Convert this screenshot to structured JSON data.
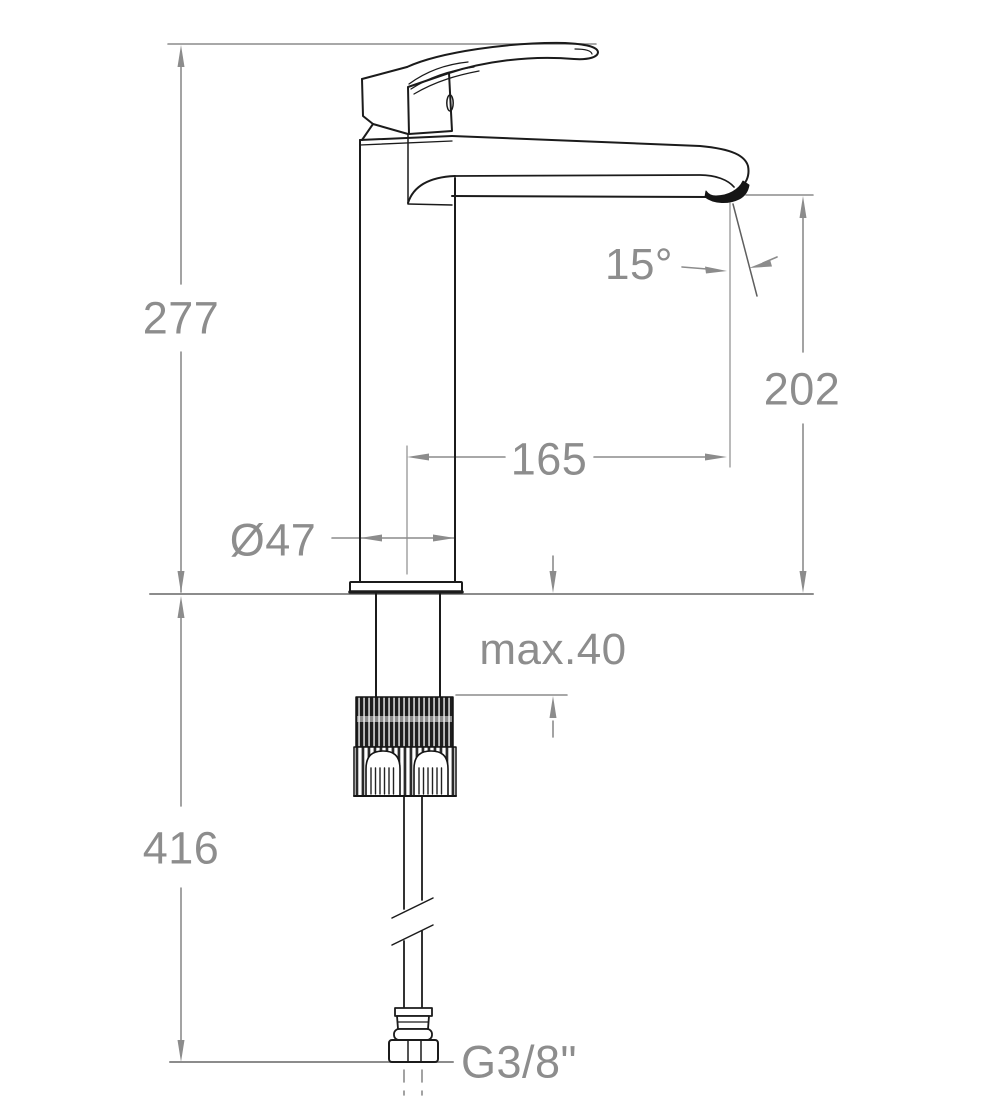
{
  "drawing": {
    "title": "Technical dimension drawing",
    "subject": "Single-lever high-spout sink mixer tap, side elevation with installation dimensions",
    "units": "mm"
  },
  "colors": {
    "background": "#ffffff",
    "outline": "#1b1b1b",
    "dimension": "#8c8c8c"
  },
  "dimensions": {
    "total_height": {
      "label": "277"
    },
    "under_counter_length": {
      "label": "416"
    },
    "spout_outlet_height": {
      "label": "202"
    },
    "spout_reach": {
      "label": "165"
    },
    "body_diameter": {
      "label": "Ø47"
    },
    "outlet_angle": {
      "label": "15°"
    },
    "max_counter_thickness": {
      "label": "max.40"
    },
    "supply_connection": {
      "label": "G3/8\""
    }
  }
}
